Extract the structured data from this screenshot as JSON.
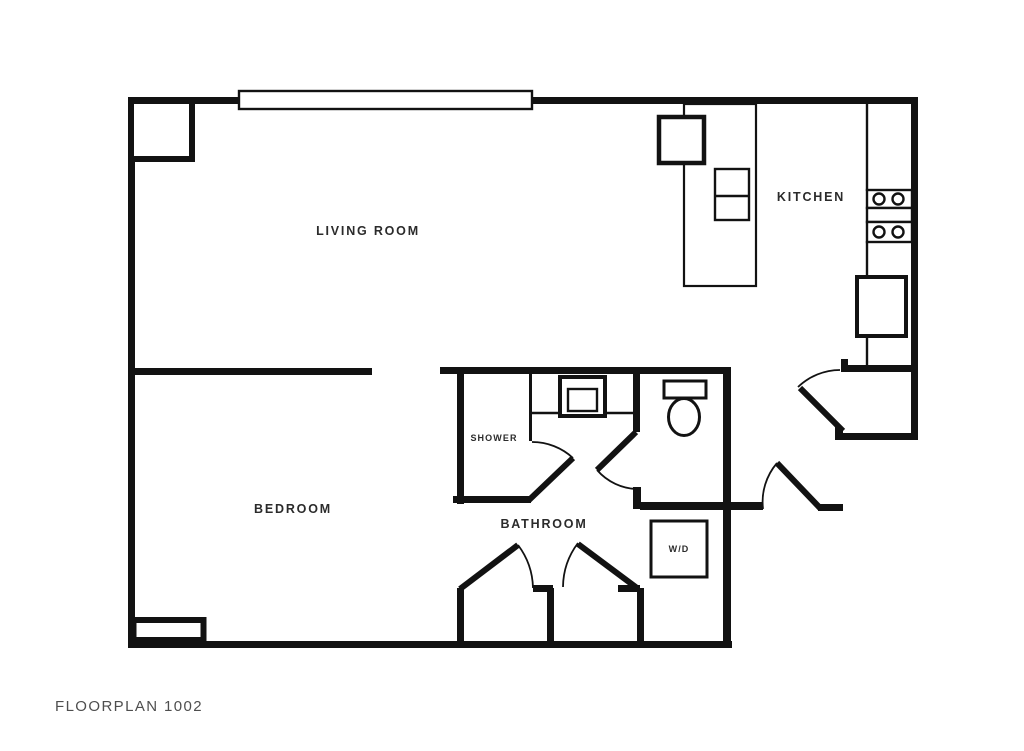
{
  "floorplan": {
    "title": "FLOORPLAN 1002",
    "colors": {
      "wall": "#121212",
      "background": "#ffffff",
      "room_label": "#2b2b2b",
      "title_text": "#4e4e4e"
    },
    "rooms": {
      "living_room": "LIVING ROOM",
      "kitchen": "KITCHEN",
      "bedroom": "BEDROOM",
      "bathroom": "BATHROOM",
      "shower": "SHOWER",
      "washer_dryer": "W/D"
    }
  }
}
